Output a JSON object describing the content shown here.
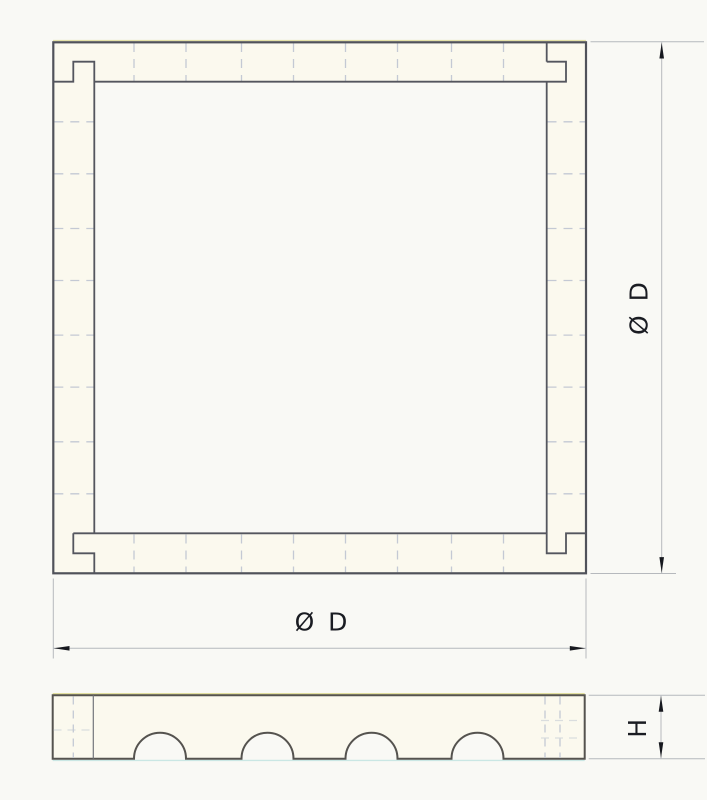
{
  "labels": {
    "diameter_right": "Ø D",
    "diameter_bottom": "Ø D",
    "height_side": "H"
  },
  "drawing": {
    "type": "engineering-two-view-drawing",
    "part": "square frame with pinwheel corner lap joints and semicircular bottom grooves",
    "colors": {
      "outline": "#50525a",
      "dim_line": "#b6b9bd",
      "hidden_line": "#c4c9d4",
      "text": "#1a1c22",
      "part_fill": "#fbf9ee",
      "paper": "#f9f9f5",
      "scan_yellow": "#ddda8f",
      "scan_cyan": "#bfe3e0"
    },
    "plan_view": {
      "corner_notches": 4,
      "hidden_groove_lines_per_wall": 8,
      "grooves_per_side": 4
    },
    "side_view": {
      "semicircular_notches": 4
    }
  }
}
